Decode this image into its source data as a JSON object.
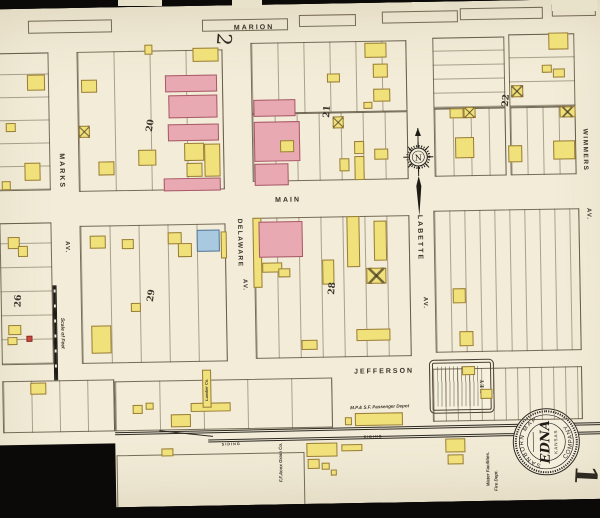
{
  "page": {
    "sheet_number_top": "2",
    "sheet_number_bottom": "1"
  },
  "compass": {
    "letter": "N"
  },
  "seal": {
    "ring_top": "SANBORN MAP",
    "ring_bottom": "COMPANY",
    "title": "EDNA",
    "subtitle": "KANSAS"
  },
  "key_box": {
    "title": "KEY"
  },
  "colors": {
    "paper": "#f2ecd8",
    "frame_yellow": "#f1e17b",
    "brick_pink": "#e9a9b3",
    "stone_blue": "#a9c9e0",
    "special_red": "#c9473f",
    "ink": "#39322a"
  },
  "adjacent_sheet_tabs": [
    [
      232,
      0,
      30,
      8
    ],
    [
      412,
      2,
      32,
      8
    ],
    [
      552,
      0,
      45,
      11
    ],
    [
      118,
      0,
      44,
      6
    ]
  ],
  "blocks": [
    [
      32,
      16,
      84,
      13,
      "",
      0
    ],
    [
      206,
      18,
      86,
      12,
      "",
      0
    ],
    [
      303,
      15,
      57,
      12,
      "",
      0
    ],
    [
      386,
      13,
      76,
      12,
      "",
      0
    ],
    [
      464,
      11,
      83,
      12,
      "",
      0
    ],
    [
      556,
      9,
      44,
      12,
      "",
      0
    ],
    [
      0,
      48,
      52,
      138,
      "h",
      23
    ],
    [
      80,
      48,
      146,
      140,
      "v",
      36
    ],
    [
      254,
      42,
      156,
      71,
      "v",
      26
    ],
    [
      254,
      113,
      156,
      68,
      "v",
      22
    ],
    [
      436,
      40,
      72,
      71,
      "h",
      14
    ],
    [
      512,
      38,
      66,
      73,
      "h",
      24
    ],
    [
      436,
      111,
      72,
      68,
      "v",
      18
    ],
    [
      512,
      111,
      66,
      68,
      "v",
      16
    ],
    [
      0,
      218,
      52,
      142,
      "h",
      24
    ],
    [
      80,
      222,
      146,
      138,
      "v",
      29
    ],
    [
      254,
      217,
      156,
      141,
      "v",
      22
    ],
    [
      434,
      213,
      146,
      142,
      "v",
      15
    ],
    [
      0,
      376,
      112,
      52,
      "v",
      28
    ],
    [
      112,
      378,
      218,
      50,
      "v",
      44
    ],
    [
      430,
      371,
      150,
      53,
      "v",
      12
    ],
    [
      113,
      452,
      188,
      54,
      "",
      0
    ]
  ],
  "buildings": [
    [
      30,
      70,
      18,
      16,
      "y",
      0
    ],
    [
      8,
      118,
      10,
      9,
      "y",
      0
    ],
    [
      26,
      158,
      16,
      18,
      "y",
      0
    ],
    [
      3,
      176,
      9,
      9,
      "y",
      0
    ],
    [
      84,
      76,
      16,
      13,
      "y",
      0
    ],
    [
      81,
      122,
      11,
      12,
      "y",
      1
    ],
    [
      100,
      158,
      16,
      14,
      "y",
      0
    ],
    [
      140,
      147,
      18,
      16,
      "y",
      0
    ],
    [
      148,
      42,
      8,
      10,
      "y",
      0
    ],
    [
      196,
      46,
      26,
      14,
      "y",
      0
    ],
    [
      168,
      73,
      52,
      17,
      "p",
      0
    ],
    [
      171,
      93,
      49,
      23,
      "p",
      0
    ],
    [
      170,
      122,
      51,
      17,
      "p",
      0
    ],
    [
      186,
      141,
      20,
      18,
      "y",
      0
    ],
    [
      206,
      142,
      16,
      33,
      "y",
      0
    ],
    [
      188,
      161,
      16,
      14,
      "y",
      0
    ],
    [
      165,
      176,
      57,
      13,
      "p",
      0
    ],
    [
      256,
      99,
      42,
      17,
      "p",
      0
    ],
    [
      256,
      121,
      46,
      40,
      "p",
      0
    ],
    [
      256,
      163,
      34,
      22,
      "p",
      0
    ],
    [
      282,
      140,
      14,
      12,
      "y",
      0
    ],
    [
      368,
      44,
      22,
      15,
      "y",
      0
    ],
    [
      376,
      65,
      15,
      14,
      "y",
      0
    ],
    [
      330,
      74,
      13,
      9,
      "y",
      0
    ],
    [
      376,
      90,
      17,
      13,
      "y",
      0
    ],
    [
      366,
      103,
      9,
      7,
      "y",
      0
    ],
    [
      335,
      117,
      11,
      12,
      "y",
      1
    ],
    [
      356,
      142,
      10,
      13,
      "y",
      0
    ],
    [
      376,
      150,
      14,
      11,
      "y",
      0
    ],
    [
      356,
      157,
      10,
      24,
      "y",
      0
    ],
    [
      341,
      159,
      10,
      13,
      "y",
      0
    ],
    [
      552,
      37,
      20,
      17,
      "y",
      0
    ],
    [
      545,
      69,
      10,
      8,
      "y",
      0
    ],
    [
      556,
      73,
      12,
      9,
      "y",
      0
    ],
    [
      514,
      89,
      12,
      12,
      "y",
      1
    ],
    [
      452,
      111,
      14,
      10,
      "y",
      0
    ],
    [
      466,
      110,
      12,
      11,
      "y",
      1
    ],
    [
      562,
      111,
      16,
      11,
      "y",
      1
    ],
    [
      457,
      140,
      19,
      21,
      "y",
      0
    ],
    [
      510,
      149,
      14,
      17,
      "y",
      0
    ],
    [
      555,
      145,
      22,
      19,
      "y",
      0
    ],
    [
      8,
      232,
      12,
      12,
      "y",
      0
    ],
    [
      18,
      241,
      10,
      11,
      "y",
      0
    ],
    [
      7,
      320,
      13,
      10,
      "y",
      0
    ],
    [
      6,
      332,
      10,
      8,
      "y",
      0
    ],
    [
      25,
      331,
      6,
      6,
      "r",
      0
    ],
    [
      28,
      378,
      16,
      12,
      "y",
      0
    ],
    [
      90,
      232,
      16,
      13,
      "y",
      0
    ],
    [
      122,
      236,
      12,
      10,
      "y",
      0
    ],
    [
      90,
      322,
      20,
      28,
      "y",
      0
    ],
    [
      130,
      300,
      10,
      9,
      "y",
      0
    ],
    [
      168,
      230,
      14,
      12,
      "y",
      0
    ],
    [
      178,
      241,
      14,
      14,
      "y",
      0
    ],
    [
      197,
      228,
      23,
      22,
      "b",
      0
    ],
    [
      221,
      230,
      6,
      27,
      "y",
      0
    ],
    [
      253,
      217,
      9,
      70,
      "y",
      0
    ],
    [
      259,
      221,
      44,
      36,
      "p",
      0
    ],
    [
      262,
      262,
      20,
      10,
      "y",
      0
    ],
    [
      278,
      268,
      12,
      9,
      "y",
      0
    ],
    [
      347,
      217,
      13,
      51,
      "y",
      0
    ],
    [
      374,
      222,
      13,
      40,
      "y",
      0
    ],
    [
      322,
      260,
      12,
      25,
      "y",
      0
    ],
    [
      366,
      269,
      20,
      16,
      "y",
      1
    ],
    [
      355,
      330,
      34,
      12,
      "y",
      0
    ],
    [
      300,
      340,
      16,
      10,
      "y",
      0
    ],
    [
      460,
      369,
      13,
      9,
      "y",
      0
    ],
    [
      452,
      291,
      13,
      15,
      "y",
      0
    ],
    [
      458,
      334,
      14,
      15,
      "y",
      0
    ],
    [
      130,
      402,
      10,
      9,
      "y",
      0
    ],
    [
      143,
      400,
      8,
      7,
      "y",
      0
    ],
    [
      168,
      412,
      20,
      13,
      "y",
      0
    ],
    [
      188,
      401,
      40,
      9,
      "y",
      0
    ],
    [
      200,
      368,
      9,
      38,
      "y",
      0
    ],
    [
      342,
      418,
      7,
      8,
      "y",
      0
    ],
    [
      478,
      392,
      12,
      10,
      "y",
      0
    ],
    [
      158,
      446,
      12,
      8,
      "y",
      0
    ],
    [
      303,
      443,
      31,
      14,
      "y",
      0
    ],
    [
      338,
      445,
      21,
      7,
      "y",
      0
    ],
    [
      304,
      459,
      12,
      10,
      "y",
      0
    ],
    [
      318,
      463,
      8,
      7,
      "y",
      0
    ],
    [
      327,
      470,
      6,
      6,
      "y",
      0
    ],
    [
      442,
      441,
      20,
      14,
      "y",
      0
    ],
    [
      444,
      457,
      16,
      10,
      "y",
      0
    ],
    [
      352,
      414,
      48,
      13,
      "y",
      0
    ]
  ],
  "labels": [
    {
      "t": "MARION",
      "x": 258,
      "y": 27,
      "r": 0,
      "s": 7,
      "ls": 2
    },
    {
      "t": "MAIN",
      "x": 289,
      "y": 200,
      "r": 0,
      "s": 7,
      "ls": 2
    },
    {
      "t": "JEFFERSON",
      "x": 382,
      "y": 373,
      "r": 0,
      "s": 7,
      "ls": 2
    },
    {
      "t": "MARKS",
      "x": 63,
      "y": 167,
      "r": 90,
      "s": 7,
      "ls": 2
    },
    {
      "t": "AV.",
      "x": 67,
      "y": 243,
      "r": 90,
      "s": 6,
      "ls": 1
    },
    {
      "t": "DELAWARE",
      "x": 240,
      "y": 242,
      "r": 90,
      "s": 6.5,
      "ls": 1.5
    },
    {
      "t": "AV.",
      "x": 244,
      "y": 284,
      "r": 90,
      "s": 6,
      "ls": 1
    },
    {
      "t": "LABETTE",
      "x": 420,
      "y": 240,
      "r": 90,
      "s": 7,
      "ls": 2
    },
    {
      "t": "AV.",
      "x": 424,
      "y": 305,
      "r": 90,
      "s": 6,
      "ls": 1
    },
    {
      "t": "WIMMERS",
      "x": 587,
      "y": 155,
      "r": 90,
      "s": 6.5,
      "ls": 1.5
    },
    {
      "t": "AV.",
      "x": 589,
      "y": 219,
      "r": 90,
      "s": 6,
      "ls": 1
    },
    {
      "t": "M.P.& S.F. Passenger Depot",
      "x": 377,
      "y": 408,
      "r": -1,
      "s": 4.5,
      "i": 1
    },
    {
      "t": "F.F.Acox Grain Co.",
      "x": 277,
      "y": 462,
      "r": -90,
      "s": 4.5,
      "i": 1
    },
    {
      "t": "Lumber Co.",
      "x": 204,
      "y": 388,
      "r": -90,
      "s": 4,
      "i": 1
    },
    {
      "t": "Water Facilities.",
      "x": 484,
      "y": 472,
      "r": -90,
      "s": 4.5,
      "i": 1
    },
    {
      "t": "Fire Dept.",
      "x": 492,
      "y": 484,
      "r": -90,
      "s": 4.5,
      "i": 1
    },
    {
      "t": "SIDING",
      "x": 228,
      "y": 443,
      "r": -1,
      "s": 3.8,
      "ls": 1
    },
    {
      "t": "SIDING",
      "x": 370,
      "y": 438,
      "r": -1,
      "s": 3.8,
      "ls": 1
    },
    {
      "t": "Scale of Feet",
      "x": 61,
      "y": 329,
      "r": 90,
      "s": 5,
      "i": 1
    },
    {
      "t": "20",
      "x": 153,
      "y": 123,
      "r": -80,
      "s": 9,
      "f": 1,
      "b": 1
    },
    {
      "t": "21",
      "x": 330,
      "y": 112,
      "r": -84,
      "s": 9,
      "f": 1,
      "b": 1
    },
    {
      "t": "22",
      "x": 509,
      "y": 104,
      "r": -84,
      "s": 9,
      "f": 1,
      "b": 1
    },
    {
      "t": "26",
      "x": 18,
      "y": 296,
      "r": -87,
      "s": 9,
      "f": 1,
      "b": 1
    },
    {
      "t": "29",
      "x": 151,
      "y": 293,
      "r": -80,
      "s": 9,
      "f": 1,
      "b": 1
    },
    {
      "t": "28",
      "x": 332,
      "y": 289,
      "r": -84,
      "s": 9,
      "f": 1,
      "b": 1
    }
  ]
}
